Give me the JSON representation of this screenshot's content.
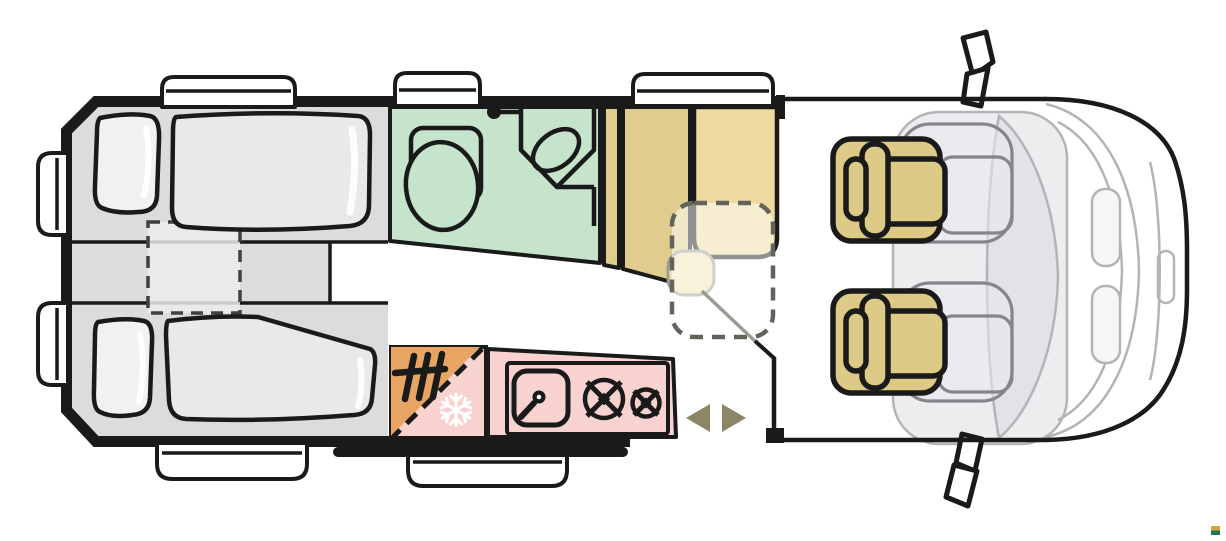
{
  "floorplan": {
    "vehicle": "campervan",
    "view": "top-down",
    "areas": [
      {
        "name": "rear-bedroom",
        "features": [
          "single-bed-top",
          "single-bed-bottom",
          "pillows",
          "removable-center-insert-dashed"
        ]
      },
      {
        "name": "bathroom",
        "features": [
          "toilet",
          "corner-washbasin",
          "shower-head"
        ]
      },
      {
        "name": "wardrobe",
        "features": [
          "tall-cabinet",
          "narrow-cabinet"
        ]
      },
      {
        "name": "dinette",
        "features": [
          "bench-seat",
          "folding-table-dashed-outline",
          "swivel-seat-ghost"
        ]
      },
      {
        "name": "kitchen",
        "features": [
          "sink",
          "faucet",
          "burner-large",
          "burner-small",
          "fridge-freezer",
          "heater"
        ]
      },
      {
        "name": "sliding-door",
        "features": [
          "direction-arrows",
          "entry-step",
          "door-rail"
        ]
      },
      {
        "name": "cab",
        "features": [
          "driver-swivel-seat",
          "passenger-swivel-seat",
          "ghost-seat-outlines",
          "windshield",
          "hood",
          "wing-mirror-top",
          "wing-mirror-bottom",
          "grille-vents"
        ]
      }
    ],
    "openings": {
      "roof_vents": 3,
      "rear_door_windows": 2,
      "side_window": 1,
      "entry_step": 1
    },
    "icons": [
      "snowflake-icon",
      "heater-icon",
      "shower-head-icon",
      "sliding-door-arrow-left",
      "sliding-door-arrow-right",
      "burner-icon",
      "faucet-icon"
    ]
  },
  "colors": {
    "outline": "#1a1a1a",
    "white": "#ffffff",
    "floor_gray": "#dcdcdc",
    "mattress": "#e9e9e9",
    "pillow": "#f1f1f1",
    "insert": "#ececec",
    "insert_dash": "#3f3f3f",
    "bathroom": "#c6e3cc",
    "wardrobe": "#e0cd8d",
    "bench": "#eeda9f",
    "blob": "#f0e4b4",
    "blob_line": "#9b9b93",
    "table_ghost": "rgba(255,255,255,0.52)",
    "dash_gray": "#63635c",
    "kitchen": "#f8d2cf",
    "heater_orange": "#e8a463",
    "cab_fill": "#ededf0",
    "cab_mid": "#e3e3e7",
    "cab_glass": "#f6f6f8",
    "cab_line": "#b3b3b8",
    "ghost_line": "#85858a",
    "ghost_fill": "rgba(233,233,238,0.55)",
    "seat_tan": "#ddca87",
    "arrow": "#8e8566",
    "logo_gold": "#cfa53d",
    "logo_green": "#20784b"
  }
}
